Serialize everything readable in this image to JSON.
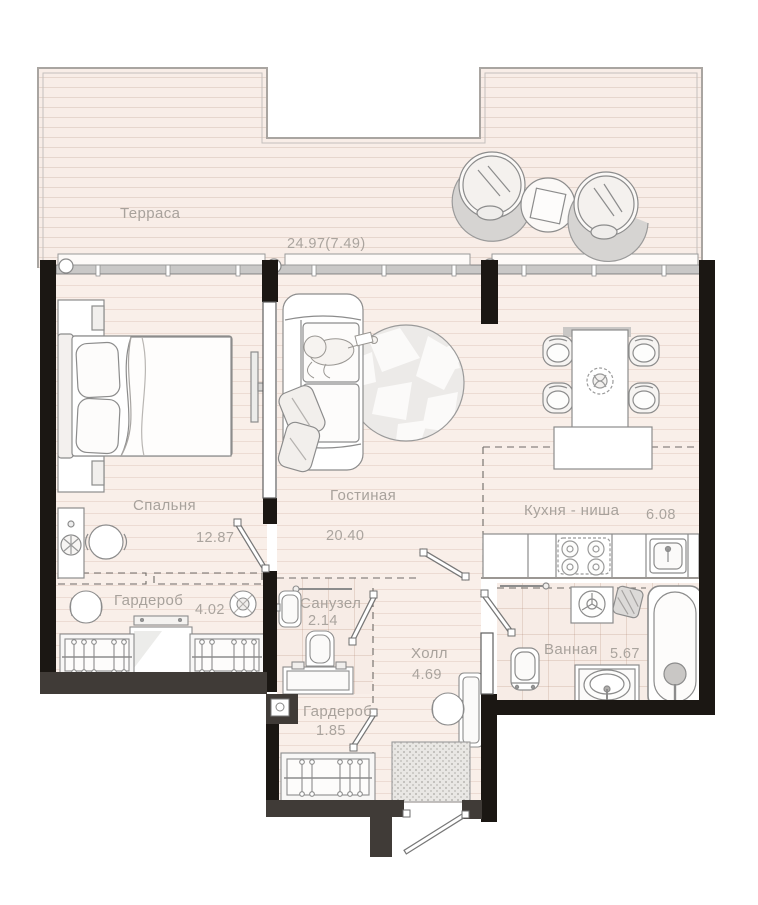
{
  "plan": {
    "type": "apartment-floor-plan",
    "rooms": {
      "terrace": {
        "name": "Терраса",
        "area": "24.97(7.49)"
      },
      "bedroom": {
        "name": "Спальня",
        "area": "12.87"
      },
      "living_room": {
        "name": "Гостиная",
        "area": "20.40"
      },
      "kitchen_niche": {
        "name": "Кухня - ниша",
        "area": "6.08"
      },
      "wardrobe_main": {
        "name": "Гардероб",
        "area": "4.02"
      },
      "wc": {
        "name": "Санузел",
        "area": "2.14"
      },
      "hall": {
        "name": "Холл",
        "area": "4.69"
      },
      "wardrobe_entry": {
        "name": "Гардероб",
        "area": "1.85"
      },
      "bathroom": {
        "name": "Ванная",
        "area": "5.67"
      }
    },
    "colors": {
      "floor": "#f9efe9",
      "floor_line": "#eadcd5",
      "wall_black": "#1b1713",
      "wall_gray": "#403b37",
      "furniture_outline": "#8c8c8c",
      "label_text": "#a8a29c",
      "glazing": "#c9c8c7"
    },
    "furniture_icons": {
      "terrace": [
        "round-lounge-chair",
        "round-lounge-chair",
        "patio-side-table",
        "deck-boards",
        "glazing-band"
      ],
      "bedroom": [
        "double-bed",
        "pillows",
        "nightstand",
        "nightstand",
        "dresser-with-plant",
        "round-armchair",
        "wall-tv"
      ],
      "living_room": [
        "sofa",
        "person-reading",
        "throw-pillows",
        "round-mosaic-rug"
      ],
      "kitchen_niche": [
        "dining-table",
        "dining-chair",
        "dining-chair",
        "dining-chair",
        "dining-chair",
        "flower-vase",
        "kitchen-island",
        "kitchen-counter",
        "stove-4-burners",
        "kitchen-sink"
      ],
      "wardrobe_main": [
        "clothes-rail-with-hangers",
        "clothes-rail-with-hangers",
        "dresser-with-mirror",
        "pouf",
        "round-mirror"
      ],
      "wc": [
        "towel-rail",
        "wash-basin",
        "toilet",
        "vanity-unit"
      ],
      "hall": [
        "console-table",
        "pouf",
        "doormat"
      ],
      "wardrobe_entry": [
        "clothes-rail-with-hangers"
      ],
      "bathroom": [
        "towel-rail",
        "washing-machine",
        "laundry-basket",
        "bathtub",
        "toilet",
        "sink-vanity"
      ],
      "doors": [
        "door-bedroom",
        "door-wc",
        "door-living-hall",
        "door-bathroom",
        "door-wardrobe-entry",
        "entry-door"
      ]
    }
  }
}
